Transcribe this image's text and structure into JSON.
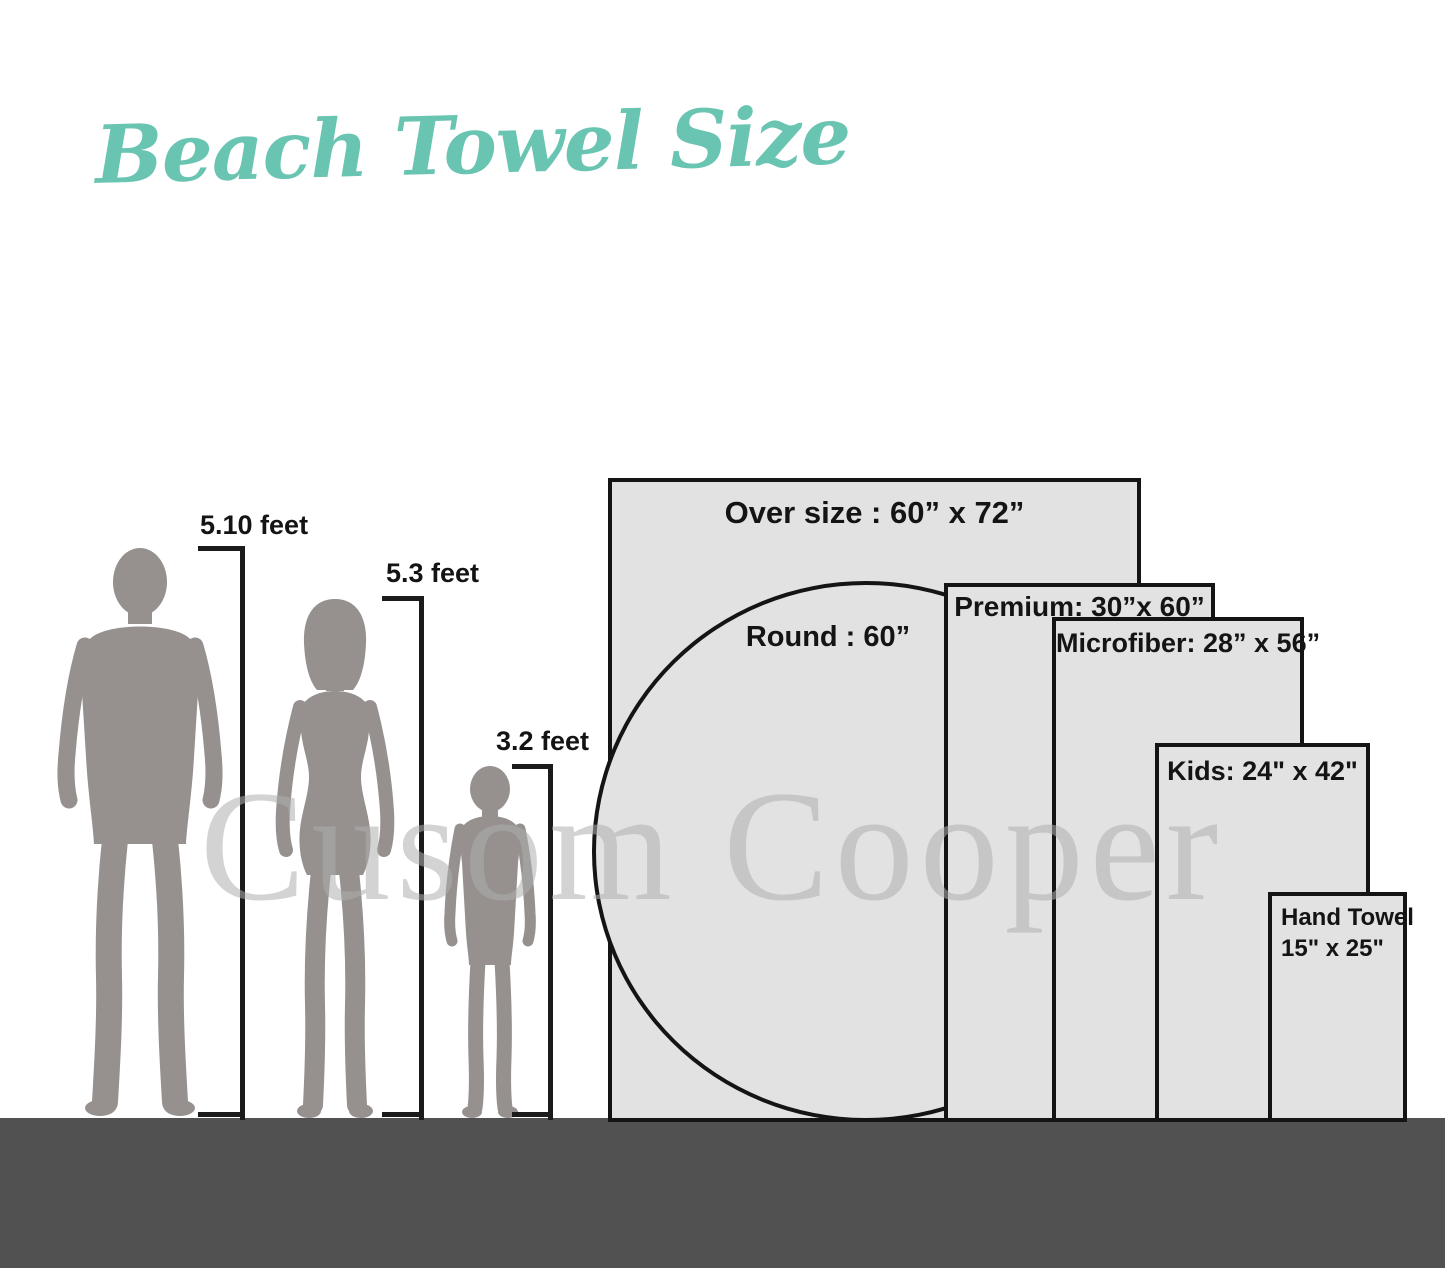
{
  "title": "Beach Towel Size",
  "watermark": "Cusom Cooper",
  "figures": [
    {
      "name": "man",
      "height_label": "5.10 feet"
    },
    {
      "name": "woman",
      "height_label": "5.3 feet"
    },
    {
      "name": "child",
      "height_label": "3.2 feet"
    }
  ],
  "towels": [
    {
      "name": "oversize",
      "label": "Over size : 60” x 72”",
      "shape": "rectangle",
      "width_in": 60,
      "length_in": 72
    },
    {
      "name": "round",
      "label": "Round : 60”",
      "shape": "circle",
      "diameter_in": 60
    },
    {
      "name": "premium",
      "label": "Premium: 30”x 60”",
      "shape": "rectangle",
      "width_in": 30,
      "length_in": 60
    },
    {
      "name": "microfiber",
      "label": "Microfiber: 28” x 56”",
      "shape": "rectangle",
      "width_in": 28,
      "length_in": 56
    },
    {
      "name": "kids",
      "label": "Kids: 24\" x 42\"",
      "shape": "rectangle",
      "width_in": 24,
      "length_in": 42
    },
    {
      "name": "hand",
      "label": "Hand Towel",
      "size_label": "15\" x 25\"",
      "shape": "rectangle",
      "width_in": 15,
      "length_in": 25
    }
  ],
  "colors": {
    "title": "#69C5B2",
    "silhouette": "#96918E",
    "towel_fill": "#E2E2E3",
    "towel_border": "#141414",
    "ground": "#515151",
    "text": "#141414",
    "watermark": "#AFAFAF"
  }
}
